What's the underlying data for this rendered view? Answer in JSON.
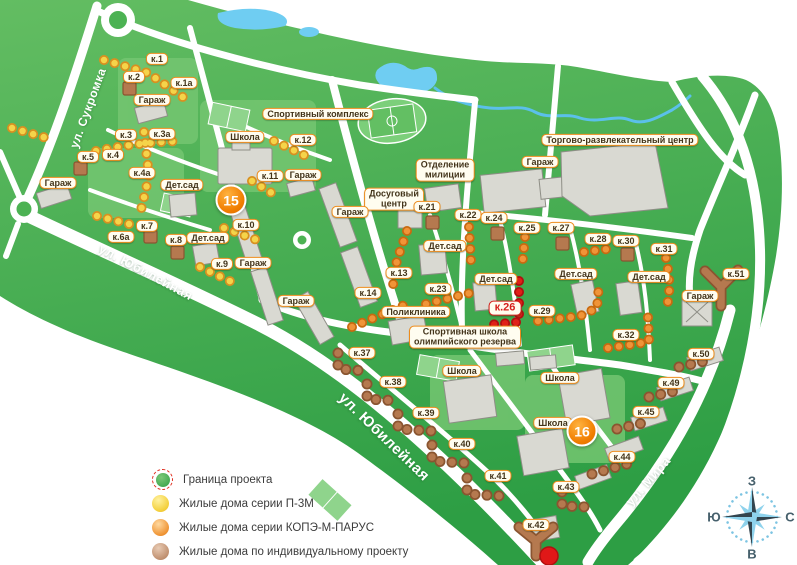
{
  "map": {
    "street_labels": [
      {
        "text": "ул. Сукромка",
        "x": 88,
        "y": 108,
        "angle": -70,
        "size": 12
      },
      {
        "text": "ул. Юбилейная",
        "x": 146,
        "y": 272,
        "angle": 28,
        "size": 13
      },
      {
        "text": "ул. Юбилейная",
        "x": 384,
        "y": 437,
        "angle": 44,
        "size": 15
      },
      {
        "text": "ул. Мира",
        "x": 648,
        "y": 481,
        "angle": -49,
        "size": 13
      }
    ],
    "building_labels": [
      {
        "text": "к.1",
        "x": 157,
        "y": 59
      },
      {
        "text": "к.1а",
        "x": 184,
        "y": 83
      },
      {
        "text": "к.2",
        "x": 134,
        "y": 77
      },
      {
        "text": "Гараж",
        "x": 152,
        "y": 100
      },
      {
        "text": "к.3",
        "x": 126,
        "y": 135
      },
      {
        "text": "к.3а",
        "x": 162,
        "y": 134
      },
      {
        "text": "к.4",
        "x": 113,
        "y": 155
      },
      {
        "text": "к.4а",
        "x": 142,
        "y": 173
      },
      {
        "text": "к.5",
        "x": 88,
        "y": 157
      },
      {
        "text": "Гараж",
        "x": 58,
        "y": 183
      },
      {
        "text": "Дет.сад",
        "x": 182,
        "y": 185
      },
      {
        "text": "к.6а",
        "x": 121,
        "y": 237
      },
      {
        "text": "к.7",
        "x": 147,
        "y": 226
      },
      {
        "text": "к.8",
        "x": 176,
        "y": 240
      },
      {
        "text": "Дет.сад",
        "x": 208,
        "y": 238
      },
      {
        "text": "к.9",
        "x": 222,
        "y": 264
      },
      {
        "text": "Гараж",
        "x": 253,
        "y": 263
      },
      {
        "text": "к.10",
        "x": 246,
        "y": 225
      },
      {
        "text": "к.11",
        "x": 270,
        "y": 176
      },
      {
        "text": "Гараж",
        "x": 303,
        "y": 175
      },
      {
        "text": "к.12",
        "x": 303,
        "y": 140
      },
      {
        "text": "Школа",
        "x": 245,
        "y": 137
      },
      {
        "text": "Спортивный комплекс",
        "x": 318,
        "y": 114
      },
      {
        "text": "Отделение\nмилиции",
        "x": 445,
        "y": 170
      },
      {
        "text": "Гараж",
        "x": 540,
        "y": 162
      },
      {
        "text": "Торгово-развлекательный центр",
        "x": 620,
        "y": 140
      },
      {
        "text": "Досуговый\nцентр",
        "x": 394,
        "y": 199
      },
      {
        "text": "Гараж",
        "x": 350,
        "y": 212
      },
      {
        "text": "Гараж",
        "x": 296,
        "y": 301
      },
      {
        "text": "к.13",
        "x": 399,
        "y": 273
      },
      {
        "text": "к.14",
        "x": 368,
        "y": 293
      },
      {
        "text": "Поликлиника",
        "x": 416,
        "y": 312
      },
      {
        "text": "Дет.сад",
        "x": 445,
        "y": 246
      },
      {
        "text": "к.21",
        "x": 427,
        "y": 207
      },
      {
        "text": "к.22",
        "x": 468,
        "y": 215
      },
      {
        "text": "к.24",
        "x": 494,
        "y": 218
      },
      {
        "text": "к.25",
        "x": 527,
        "y": 228
      },
      {
        "text": "к.27",
        "x": 561,
        "y": 228
      },
      {
        "text": "к.28",
        "x": 598,
        "y": 239
      },
      {
        "text": "к.30",
        "x": 626,
        "y": 241
      },
      {
        "text": "к.31",
        "x": 664,
        "y": 249
      },
      {
        "text": "к.51",
        "x": 736,
        "y": 274
      },
      {
        "text": "Дет.сад",
        "x": 496,
        "y": 279
      },
      {
        "text": "Дет.сад",
        "x": 576,
        "y": 274
      },
      {
        "text": "Дет.сад",
        "x": 649,
        "y": 277
      },
      {
        "text": "Гараж",
        "x": 700,
        "y": 296
      },
      {
        "text": "к.23",
        "x": 438,
        "y": 289
      },
      {
        "text": "к.26",
        "x": 505,
        "y": 308,
        "style": "red"
      },
      {
        "text": "к.29",
        "x": 542,
        "y": 311
      },
      {
        "text": "к.32",
        "x": 626,
        "y": 335
      },
      {
        "text": "Спортивная школа\nолимпийского резерва",
        "x": 465,
        "y": 337
      },
      {
        "text": "Школа",
        "x": 462,
        "y": 371
      },
      {
        "text": "Школа",
        "x": 560,
        "y": 378
      },
      {
        "text": "Школа",
        "x": 553,
        "y": 423
      },
      {
        "text": "к.37",
        "x": 362,
        "y": 353
      },
      {
        "text": "к.38",
        "x": 393,
        "y": 382
      },
      {
        "text": "к.39",
        "x": 426,
        "y": 413
      },
      {
        "text": "к.40",
        "x": 462,
        "y": 444
      },
      {
        "text": "к.41",
        "x": 498,
        "y": 476
      },
      {
        "text": "к.42",
        "x": 536,
        "y": 525
      },
      {
        "text": "к.43",
        "x": 566,
        "y": 487
      },
      {
        "text": "к.44",
        "x": 622,
        "y": 457
      },
      {
        "text": "к.45",
        "x": 646,
        "y": 412
      },
      {
        "text": "к.49",
        "x": 671,
        "y": 383
      },
      {
        "text": "к.50",
        "x": 701,
        "y": 354
      }
    ],
    "markers": [
      {
        "text": "15",
        "x": 231,
        "y": 200
      },
      {
        "text": "16",
        "x": 582,
        "y": 431
      }
    ]
  },
  "legend": {
    "items": [
      {
        "label": "Граница проекта",
        "swatch": "boundary"
      },
      {
        "label": "Жилые дома серии П-3М",
        "swatch": "yellow"
      },
      {
        "label": "Жилые дома серии КОПЭ-М-ПАРУС",
        "swatch": "orange"
      },
      {
        "label": "Жилые дома по индивидуальному проекту",
        "swatch": "brown"
      }
    ]
  },
  "compass": {
    "top": "З",
    "right": "С",
    "bottom": "В",
    "left": "Ю"
  },
  "colors": {
    "map_green": "#3fae4c",
    "water": "#6fcdf2",
    "label_border": "#ee8c1c",
    "highlight_red": "#d6201c",
    "marker_orange": "#f07d00",
    "series_p3m": "#f3cf3a",
    "series_kope": "#ef9434",
    "series_individual": "#b5794f"
  }
}
